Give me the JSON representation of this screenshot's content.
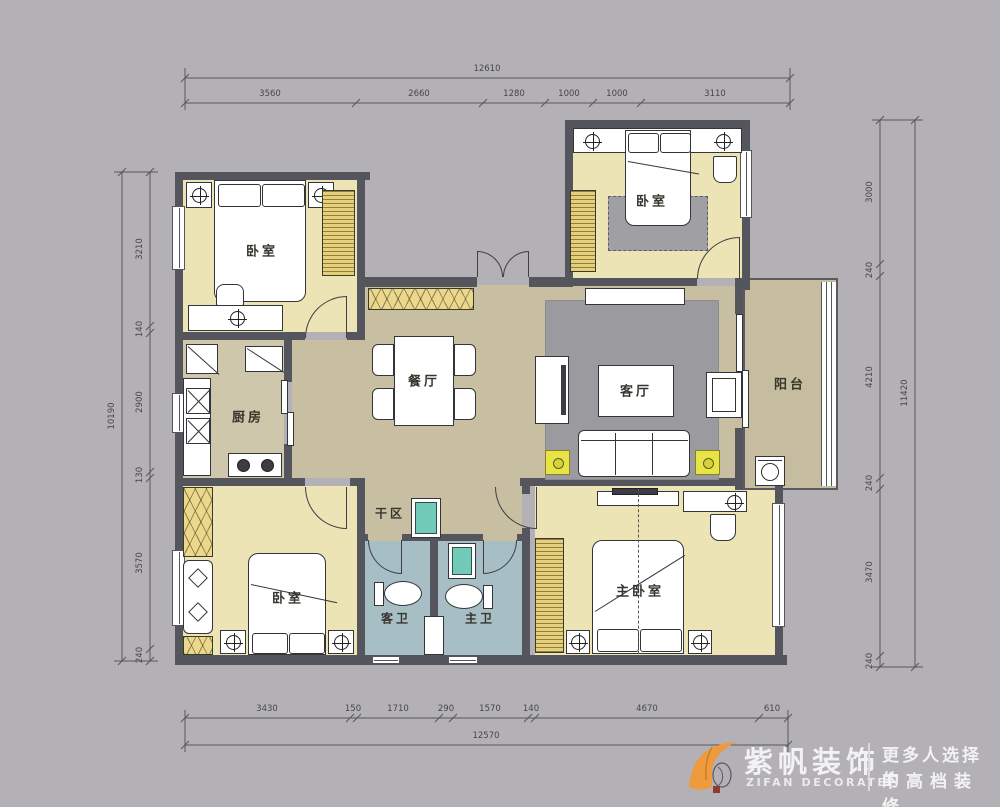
{
  "plan": {
    "type": "apartment-floor-plan",
    "rooms": {
      "bedroom_top_left": {
        "label": "卧室"
      },
      "bedroom_top_right": {
        "label": "卧室"
      },
      "bedroom_bottom_left": {
        "label": "卧室"
      },
      "master_bedroom": {
        "label": "主卧室"
      },
      "dining": {
        "label": "餐厅"
      },
      "living": {
        "label": "客厅"
      },
      "kitchen": {
        "label": "厨房"
      },
      "balcony": {
        "label": "阳台"
      },
      "dry_area": {
        "label": "干区"
      },
      "guest_bath": {
        "label": "客卫"
      },
      "master_bath": {
        "label": "主卫"
      }
    },
    "colors": {
      "background": "#b3b1b6",
      "wall": "#54555d",
      "bedroom_floor": "#ece4b5",
      "hall_floor": "#c8bfa2",
      "bath_floor": "#a7bfc4",
      "wardrobe_yellow": "#e6cf79",
      "cabinet_yellow": "#ecd88d",
      "speaker_yellow": "#e9e446",
      "basin_teal": "#72cab9",
      "logo_orange": "#ee9a3d"
    }
  },
  "dims": {
    "top": {
      "total": "12610",
      "segments": [
        "3560",
        "2660",
        "1280",
        "1000",
        "1000",
        "3110"
      ]
    },
    "bottom": {
      "total": "12570",
      "segments": [
        "3430",
        "150",
        "1710",
        "290",
        "1570",
        "140",
        "4670",
        "610"
      ]
    },
    "left": {
      "total": "10190",
      "segments": [
        "3210",
        "140",
        "2900",
        "130",
        "3570",
        "240"
      ]
    },
    "right": {
      "total": "11420",
      "segments": [
        "3000",
        "240",
        "4210",
        "240",
        "3470",
        "240"
      ]
    }
  },
  "logo": {
    "brand_cn": "紫帆装饰",
    "brand_en": "ZIFAN DECORATE",
    "tagline_line1": "更多人选择的",
    "tagline_line2": "中高档装修"
  }
}
